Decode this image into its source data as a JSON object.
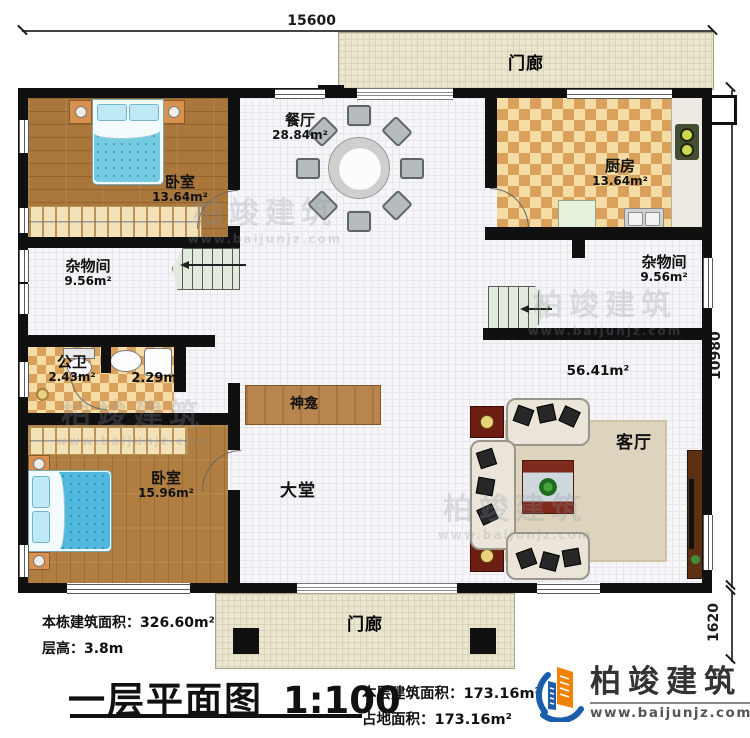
{
  "title_block": {
    "title": "一层平面图",
    "scale": "1:100",
    "building_area_label": "本栋建筑面积：",
    "building_area_value": "326.60m²",
    "floor_height_label": "层高：",
    "floor_height_value": "3.8m",
    "floor_area_label": "本层建筑面积：",
    "floor_area_value": "173.16m²",
    "footprint_label": "占地面积：",
    "footprint_value": "173.16m²"
  },
  "brand": {
    "name": "柏竣建筑",
    "website": "www.baijunjz.com"
  },
  "watermark": {
    "line1": "柏竣建筑",
    "line2": "www.baijunjz.com"
  },
  "dimensions": {
    "top": "15600",
    "right_main": "10980",
    "right_porch": "1620"
  },
  "rooms": {
    "porch_top": {
      "name": "门廊"
    },
    "dining": {
      "name": "餐厅",
      "area": "28.84m²"
    },
    "kitchen": {
      "name": "厨房",
      "area": "13.64m²"
    },
    "bedroom_top": {
      "name": "卧室",
      "area": "13.64m²"
    },
    "storage_left": {
      "name": "杂物间",
      "area": "9.56m²"
    },
    "storage_right": {
      "name": "杂物间",
      "area": "9.56m²"
    },
    "bathroom": {
      "name": "公卫",
      "area": "2.43m²"
    },
    "laundry": {
      "area": "2.29m²"
    },
    "shrine": {
      "name": "神龛"
    },
    "hall": {
      "name": "大堂"
    },
    "bedroom_bottom": {
      "name": "卧室",
      "area": "15.96m²"
    },
    "living": {
      "name": "客厅",
      "area": "56.41m²"
    },
    "porch_bottom": {
      "name": "门廊"
    }
  }
}
